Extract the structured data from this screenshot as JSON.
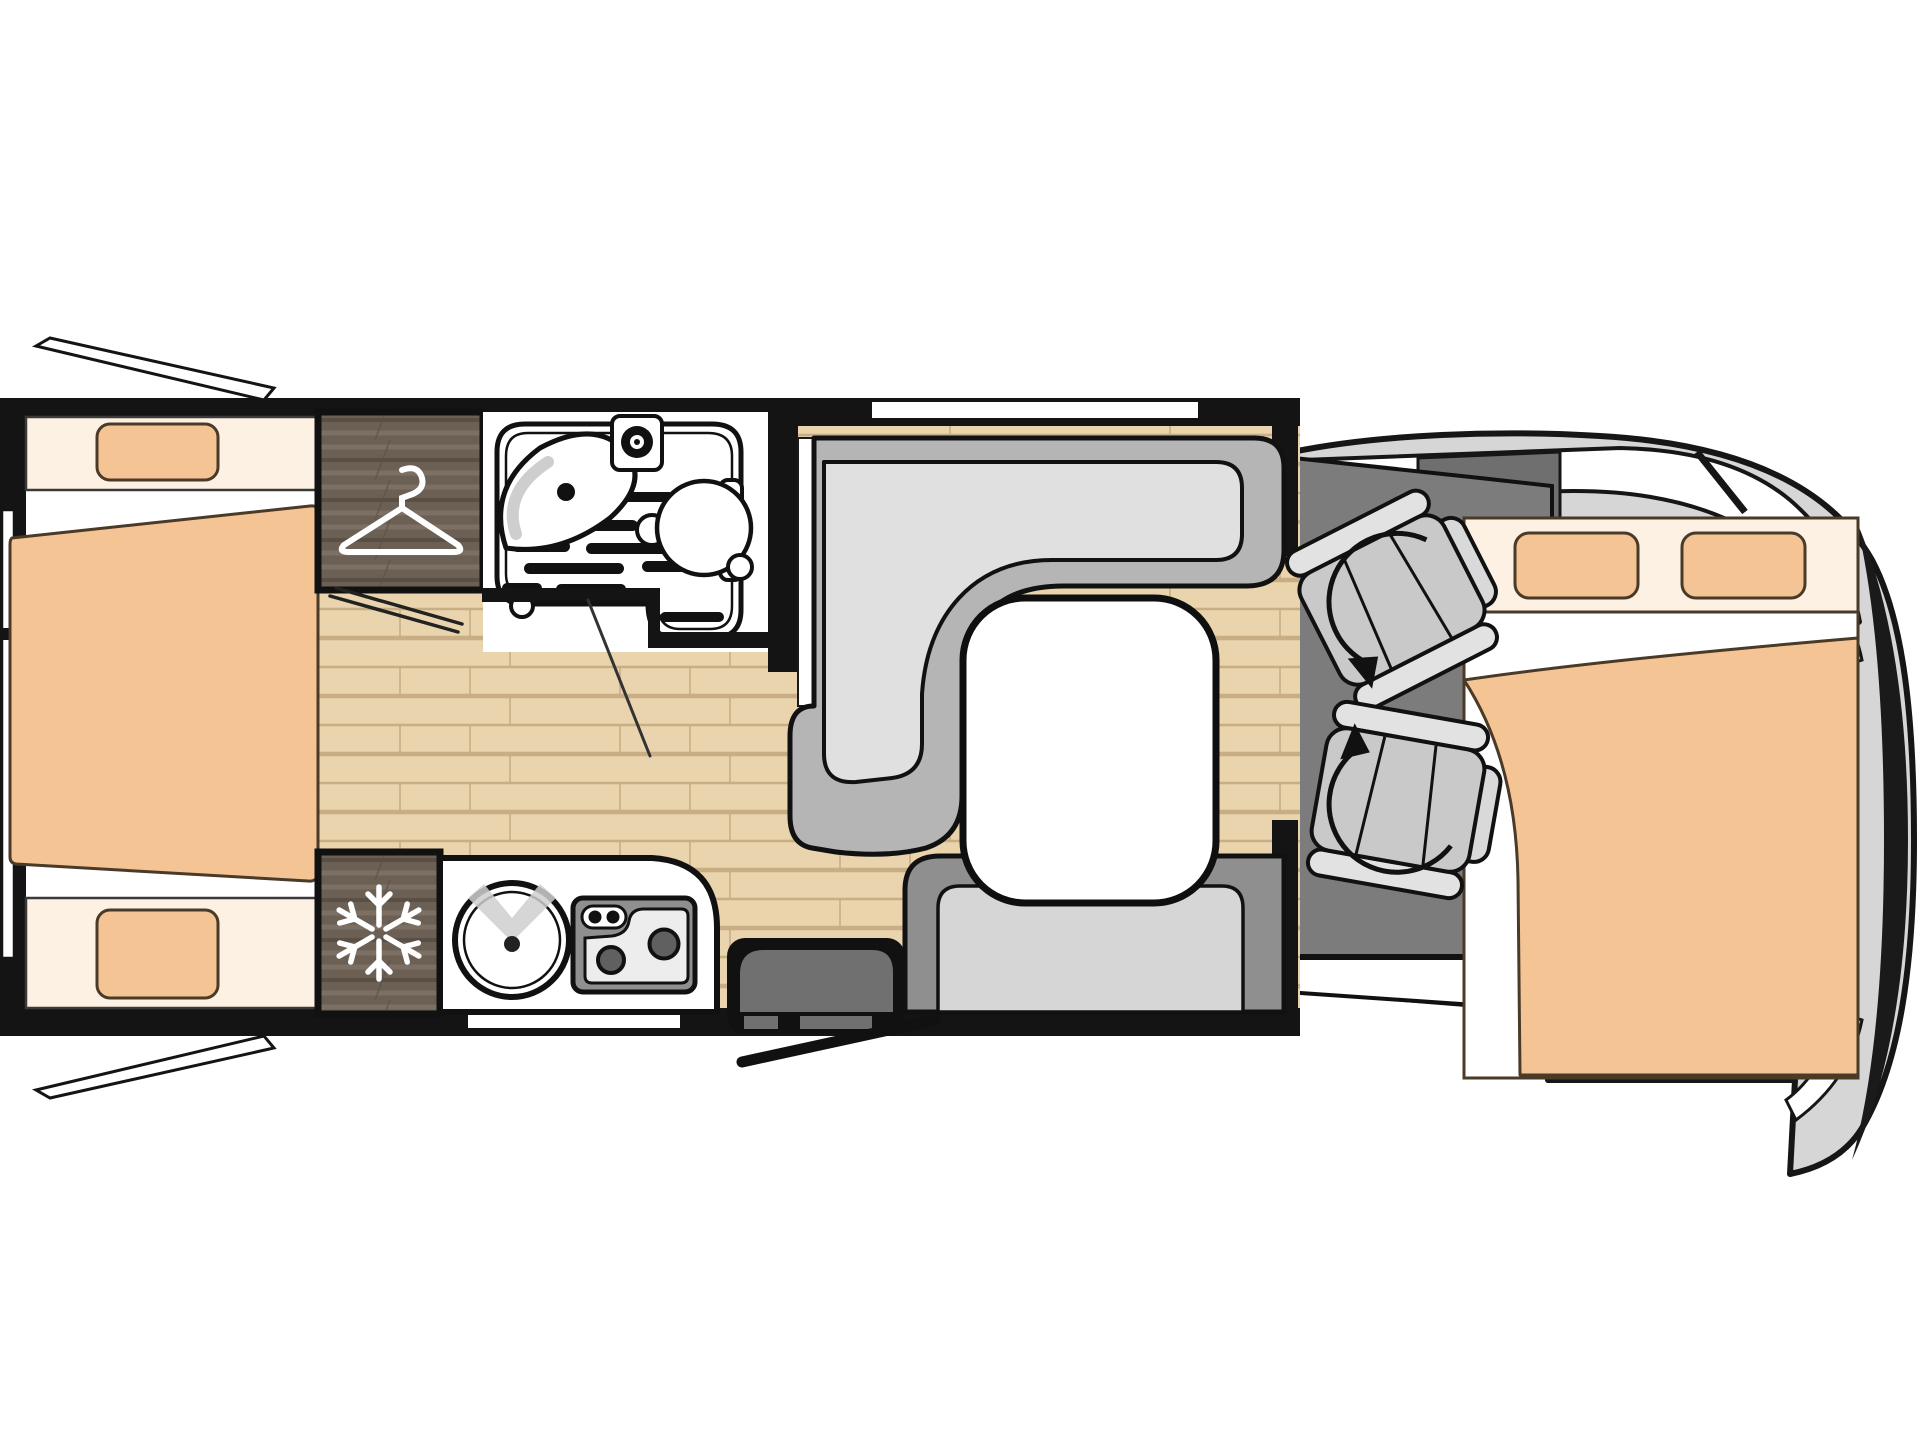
{
  "meta": {
    "title": "Motorhome floor plan (top view)",
    "kind": "floor-plan-diagram",
    "visible_text": []
  },
  "colors": {
    "background": "#ffffff",
    "outline": "#141414",
    "wall": "#141414",
    "wood_floor": "#e9d4ae",
    "wood_plank_line": "#c8ad85",
    "dark_wood": "#6c6054",
    "dark_wood_grain_light": "#7e7166",
    "dark_wood_grain_dark": "#584e44",
    "bed_fabric": "#f5c495",
    "bed_linen": "#fcf1e3",
    "bed_outline": "#4a3a28",
    "bench_back": "#b5b5b5",
    "bench_cushion": "#e0e0e0",
    "rear_bench_back": "#8f8f8f",
    "rear_bench_cushion": "#d6d6d6",
    "cab_floor": "#7c7c7c",
    "cab_body": "#d6d6d6",
    "seat_gray": "#c9c9c9",
    "seat_trim": "#e2e2e2",
    "seat_headrest": "#d9d9d9",
    "step_gray": "#707070",
    "stove_body": "#8f8f8f",
    "stove_panel": "#ededed",
    "burner": "#606060",
    "white": "#ffffff"
  },
  "rooms": [
    {
      "name": "rear-bedroom",
      "features": [
        "single-bed-top",
        "single-bed-bottom",
        "shared-duvet",
        "wardrobe",
        "rear-window",
        "awning-window-top",
        "awning-window-bottom"
      ]
    },
    {
      "name": "washroom",
      "features": [
        "shower-tray",
        "washbasin",
        "faucet",
        "toilet",
        "pivoting-wall",
        "door"
      ]
    },
    {
      "name": "kitchen",
      "features": [
        "round-sink",
        "two-burner-hob",
        "refrigerator",
        "service-hatch"
      ]
    },
    {
      "name": "lounge-dinette",
      "features": [
        "l-shaped-bench",
        "side-bench",
        "pedestal-table",
        "lounge-window",
        "entry-door",
        "entry-step"
      ]
    },
    {
      "name": "cab",
      "features": [
        "passenger-swivel-seat",
        "driver-swivel-seat",
        "drop-down-double-bed",
        "windshield",
        "vehicle-nose"
      ]
    }
  ],
  "icons": [
    {
      "name": "hanger-icon",
      "meaning": "wardrobe"
    },
    {
      "name": "snowflake-icon",
      "meaning": "refrigerator"
    },
    {
      "name": "swivel-arrow-icon",
      "meaning": "rotating cab seat"
    }
  ],
  "openings": [
    {
      "name": "entry-door",
      "state": "open"
    },
    {
      "name": "bedroom-door",
      "state": "open"
    },
    {
      "name": "washroom-door",
      "state": "open"
    },
    {
      "name": "awning-window-top-left",
      "state": "open"
    },
    {
      "name": "awning-window-bottom-left",
      "state": "open"
    },
    {
      "name": "rear-window",
      "state": "closed"
    },
    {
      "name": "lounge-window",
      "state": "closed"
    },
    {
      "name": "kitchen-service-hatch",
      "state": "closed"
    }
  ]
}
